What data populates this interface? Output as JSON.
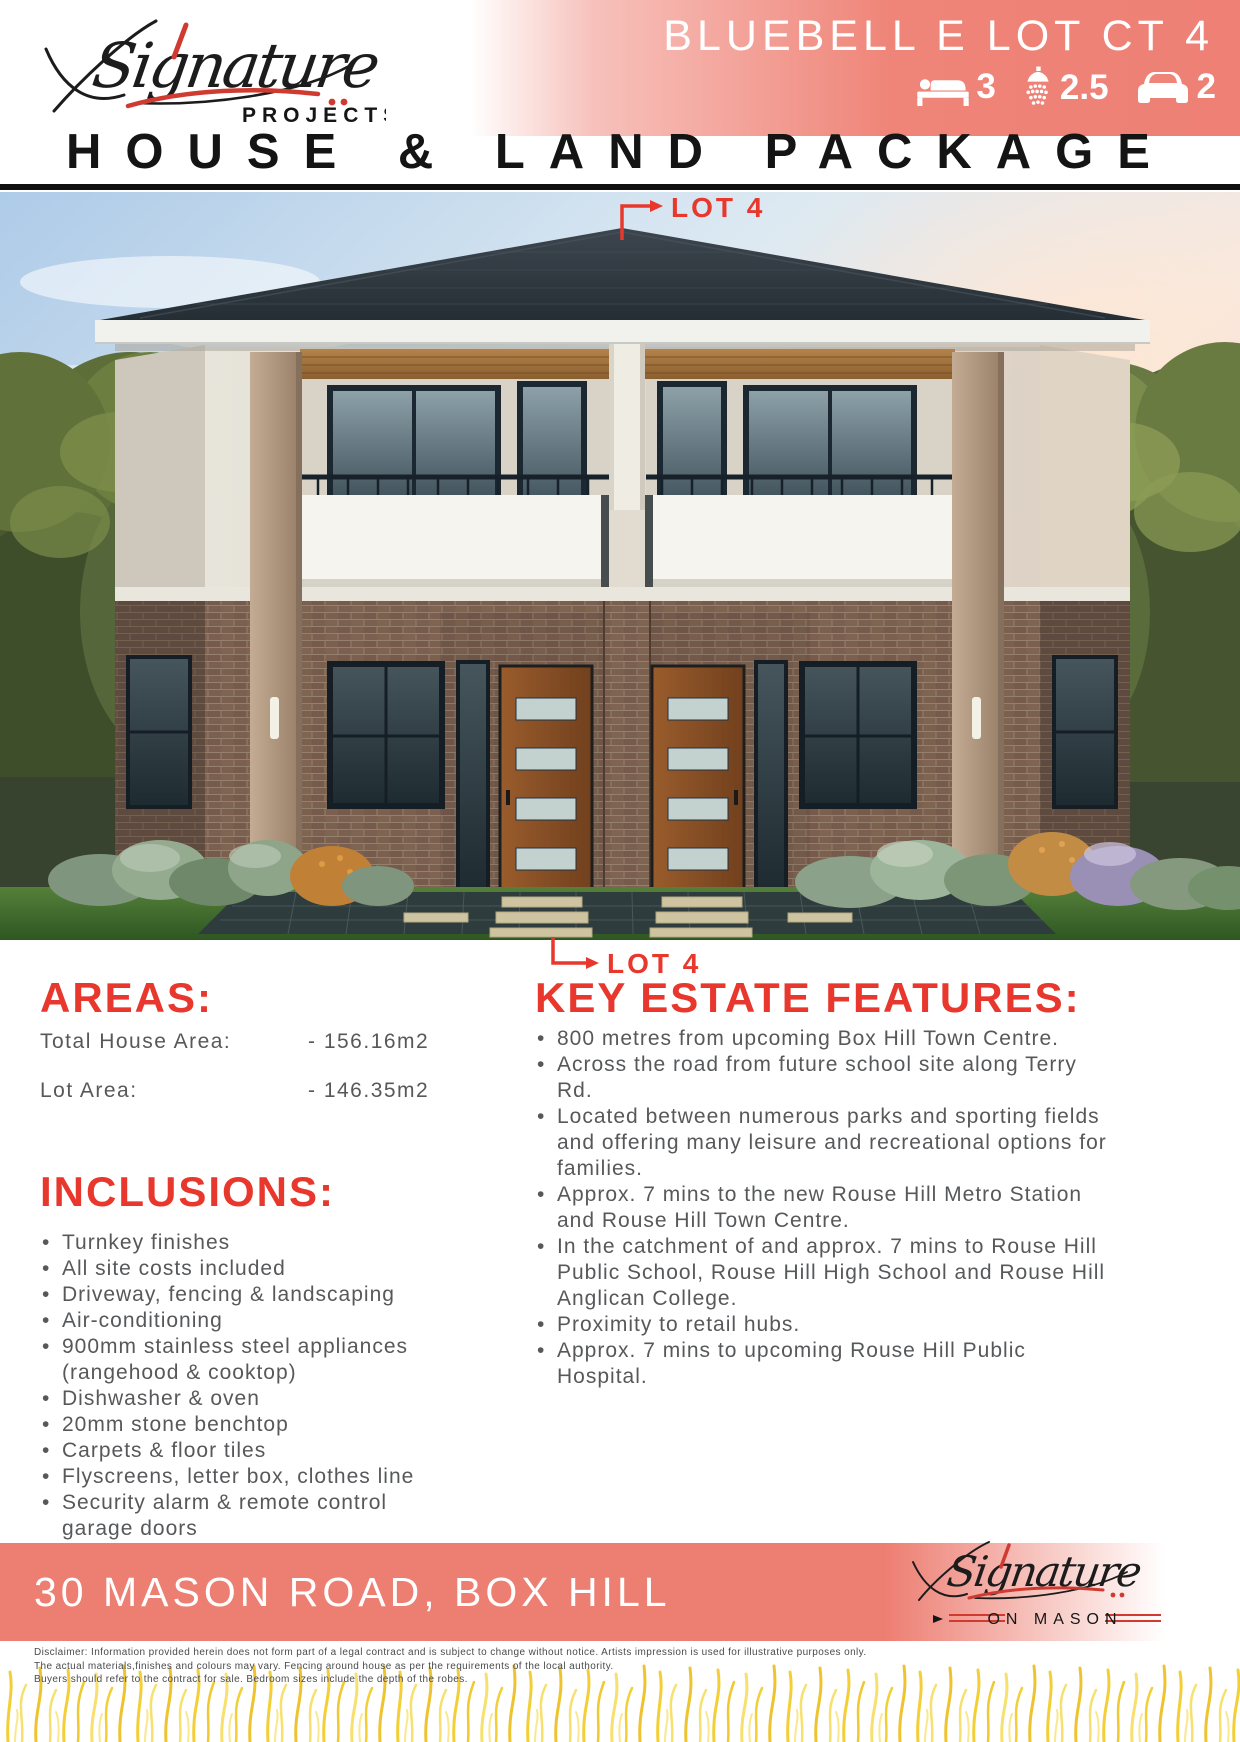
{
  "brand": {
    "name": "Signature",
    "division": "PROJECTS",
    "footer_division": "ON MASON"
  },
  "header": {
    "banner_title": "BLUEBELL E LOT CT 4",
    "stats": [
      {
        "icon": "bed-icon",
        "value": "3"
      },
      {
        "icon": "shower-icon",
        "value": "2.5"
      },
      {
        "icon": "car-icon",
        "value": "2"
      }
    ],
    "page_title": "HOUSE & LAND PACKAGE"
  },
  "hero": {
    "lot_label_top": "LOT 4",
    "lot_label_bottom": "LOT 4"
  },
  "areas": {
    "heading": "AREAS:",
    "rows": [
      {
        "label": "Total House Area:",
        "value": "- 156.16m2"
      },
      {
        "label": "Lot Area:",
        "value": "- 146.35m2"
      }
    ]
  },
  "inclusions": {
    "heading": "INCLUSIONS:",
    "items": [
      "Turnkey finishes",
      "All site costs included",
      "Driveway, fencing & landscaping",
      "Air-conditioning",
      "900mm stainless steel appliances (rangehood & cooktop)",
      "Dishwasher & oven",
      "20mm stone benchtop",
      "Carpets & floor tiles",
      "Flyscreens, letter box, clothes line",
      "Security alarm & remote control garage doors"
    ]
  },
  "features": {
    "heading": "KEY ESTATE FEATURES:",
    "items": [
      "800 metres from upcoming Box Hill Town Centre.",
      "Across the road from future school site along Terry Rd.",
      "Located between numerous parks and sporting fields and offering many leisure and recreational options for families.",
      "Approx. 7 mins to the new Rouse Hill Metro Station and Rouse Hill Town Centre.",
      "In the catchment of and approx. 7 mins to Rouse Hill Public School, Rouse Hill High School and Rouse Hill Anglican College.",
      "Proximity to retail hubs.",
      "Approx. 7 mins to upcoming Rouse Hill Public Hospital."
    ]
  },
  "footer": {
    "address": "30 MASON ROAD, BOX HILL",
    "disclaimer": [
      "Disclaimer: Information provided herein does not form part of a legal contract and is subject to change without notice. Artists impression is used for illustrative purposes only.",
      "The actual materials,finishes and colours may vary. Fencing around house as per the requirements of the local authority.",
      "Buyers should refer to the contract for sale. Bedroom sizes include the depth of the robes."
    ]
  },
  "colors": {
    "accent_red": "#e8382d",
    "banner_salmon": "#ef8478",
    "bar_salmon": "#ed7e72",
    "body_text_gray": "#57585a",
    "logo_red": "#cf3a31",
    "title_black": "#141414"
  }
}
